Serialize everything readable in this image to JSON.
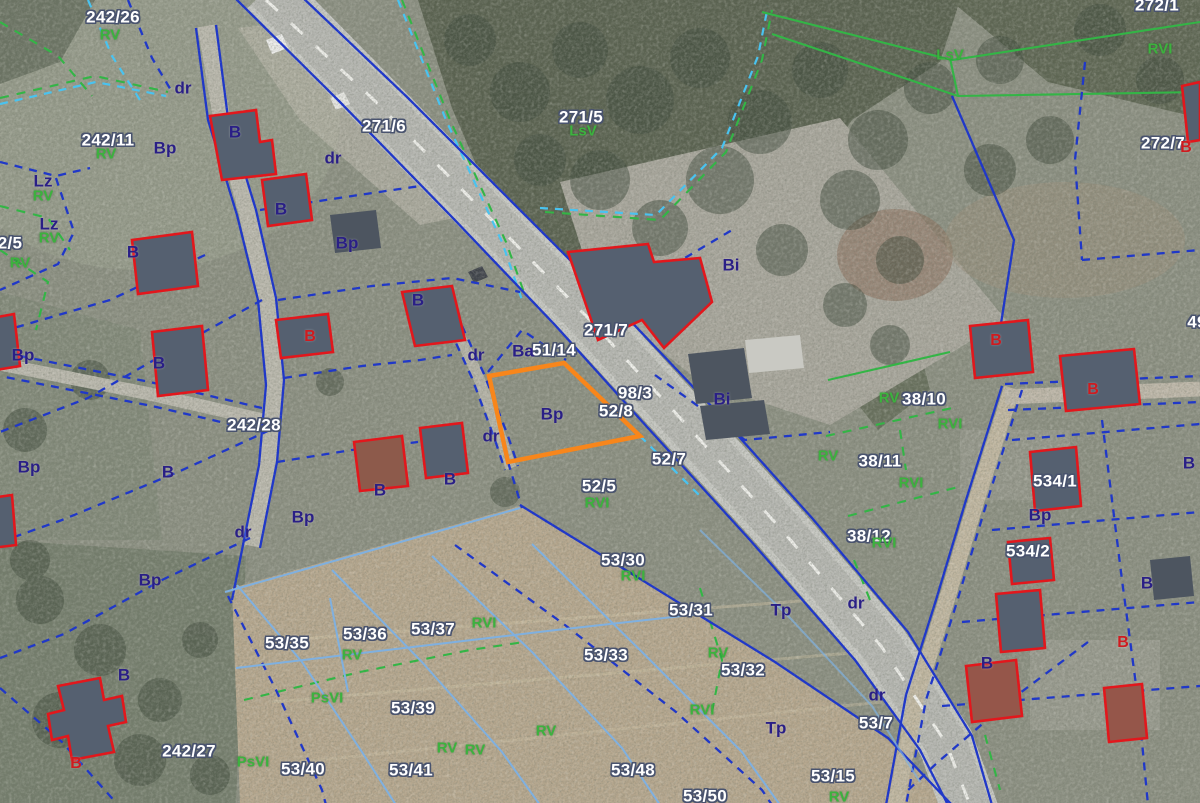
{
  "map": {
    "type": "cadastral-aerial-map",
    "colors": {
      "parcel_text": "#ffffff",
      "parcel_outline": "#49536e",
      "landuse_blue": "#2a1f86",
      "landuse_green": "#3cb23e",
      "building_red_label": "#cf1b1f",
      "boundary_navy": "#2038c8",
      "boundary_cyan": "#49c3f0",
      "boundary_green": "#33b546",
      "field_line_blue": "#7fb0e0",
      "building_outline": "#e2171c",
      "highlight_orange": "#f8861b",
      "road_dash_white": "#f0f0ec"
    },
    "highlighted_parcel": "52/8",
    "labels": [
      {
        "t": "242/26",
        "x": 113,
        "y": 17,
        "k": "p"
      },
      {
        "t": "271/6",
        "x": 384,
        "y": 126,
        "k": "p"
      },
      {
        "t": "271/5",
        "x": 581,
        "y": 117,
        "k": "p"
      },
      {
        "t": "242/11",
        "x": 108,
        "y": 140,
        "k": "p"
      },
      {
        "t": "272/1",
        "x": 1157,
        "y": 5,
        "k": "p"
      },
      {
        "t": "272/7",
        "x": 1163,
        "y": 143,
        "k": "p"
      },
      {
        "t": "2/5",
        "x": 10,
        "y": 243,
        "k": "p"
      },
      {
        "t": "271/7",
        "x": 606,
        "y": 330,
        "k": "p"
      },
      {
        "t": "51/14",
        "x": 554,
        "y": 350,
        "k": "p"
      },
      {
        "t": "98/3",
        "x": 635,
        "y": 393,
        "k": "p"
      },
      {
        "t": "52/8",
        "x": 616,
        "y": 411,
        "k": "p"
      },
      {
        "t": "242/28",
        "x": 254,
        "y": 425,
        "k": "p"
      },
      {
        "t": "38/10",
        "x": 924,
        "y": 399,
        "k": "p"
      },
      {
        "t": "52/7",
        "x": 669,
        "y": 459,
        "k": "p"
      },
      {
        "t": "38/11",
        "x": 880,
        "y": 461,
        "k": "p"
      },
      {
        "t": "52/5",
        "x": 599,
        "y": 486,
        "k": "p"
      },
      {
        "t": "534/1",
        "x": 1055,
        "y": 481,
        "k": "p"
      },
      {
        "t": "38/12",
        "x": 869,
        "y": 536,
        "k": "p"
      },
      {
        "t": "534/2",
        "x": 1028,
        "y": 551,
        "k": "p"
      },
      {
        "t": "53/30",
        "x": 623,
        "y": 560,
        "k": "p"
      },
      {
        "t": "49",
        "x": 1197,
        "y": 322,
        "k": "p"
      },
      {
        "t": "53/31",
        "x": 691,
        "y": 610,
        "k": "p"
      },
      {
        "t": "53/36",
        "x": 365,
        "y": 634,
        "k": "p"
      },
      {
        "t": "53/35",
        "x": 287,
        "y": 643,
        "k": "p"
      },
      {
        "t": "53/37",
        "x": 433,
        "y": 629,
        "k": "p"
      },
      {
        "t": "53/33",
        "x": 606,
        "y": 655,
        "k": "p"
      },
      {
        "t": "53/32",
        "x": 743,
        "y": 670,
        "k": "p"
      },
      {
        "t": "53/39",
        "x": 413,
        "y": 708,
        "k": "p"
      },
      {
        "t": "53/7",
        "x": 876,
        "y": 723,
        "k": "p"
      },
      {
        "t": "242/27",
        "x": 189,
        "y": 751,
        "k": "p"
      },
      {
        "t": "53/40",
        "x": 303,
        "y": 769,
        "k": "p"
      },
      {
        "t": "53/41",
        "x": 411,
        "y": 770,
        "k": "p"
      },
      {
        "t": "53/48",
        "x": 633,
        "y": 770,
        "k": "p"
      },
      {
        "t": "53/15",
        "x": 833,
        "y": 776,
        "k": "p"
      },
      {
        "t": "53/50",
        "x": 705,
        "y": 796,
        "k": "p"
      },
      {
        "t": "dr",
        "x": 183,
        "y": 88,
        "k": "u"
      },
      {
        "t": "B",
        "x": 235,
        "y": 132,
        "k": "u"
      },
      {
        "t": "Bp",
        "x": 165,
        "y": 148,
        "k": "u"
      },
      {
        "t": "dr",
        "x": 333,
        "y": 158,
        "k": "u"
      },
      {
        "t": "Lz",
        "x": 43,
        "y": 181,
        "k": "u"
      },
      {
        "t": "B",
        "x": 281,
        "y": 209,
        "k": "u"
      },
      {
        "t": "Lz",
        "x": 49,
        "y": 224,
        "k": "u"
      },
      {
        "t": "Bp",
        "x": 347,
        "y": 243,
        "k": "u"
      },
      {
        "t": "B",
        "x": 133,
        "y": 252,
        "k": "u"
      },
      {
        "t": "Bi",
        "x": 731,
        "y": 265,
        "k": "u"
      },
      {
        "t": "B",
        "x": 418,
        "y": 300,
        "k": "u"
      },
      {
        "t": "Ba",
        "x": 523,
        "y": 351,
        "k": "u"
      },
      {
        "t": "dr",
        "x": 476,
        "y": 355,
        "k": "u"
      },
      {
        "t": "Bp",
        "x": 23,
        "y": 355,
        "k": "u"
      },
      {
        "t": "B",
        "x": 159,
        "y": 363,
        "k": "u"
      },
      {
        "t": "Bi",
        "x": 722,
        "y": 399,
        "k": "u"
      },
      {
        "t": "Bp",
        "x": 552,
        "y": 414,
        "k": "u"
      },
      {
        "t": "dr",
        "x": 491,
        "y": 436,
        "k": "u"
      },
      {
        "t": "Bp",
        "x": 29,
        "y": 467,
        "k": "u"
      },
      {
        "t": "B",
        "x": 168,
        "y": 472,
        "k": "u"
      },
      {
        "t": "B",
        "x": 450,
        "y": 479,
        "k": "u"
      },
      {
        "t": "B",
        "x": 380,
        "y": 490,
        "k": "u"
      },
      {
        "t": "Bp",
        "x": 303,
        "y": 517,
        "k": "u"
      },
      {
        "t": "dr",
        "x": 243,
        "y": 532,
        "k": "u"
      },
      {
        "t": "Bp",
        "x": 150,
        "y": 580,
        "k": "u"
      },
      {
        "t": "Bp",
        "x": 1040,
        "y": 515,
        "k": "u"
      },
      {
        "t": "B",
        "x": 1189,
        "y": 463,
        "k": "u"
      },
      {
        "t": "dr",
        "x": 856,
        "y": 603,
        "k": "u"
      },
      {
        "t": "Tp",
        "x": 781,
        "y": 610,
        "k": "u"
      },
      {
        "t": "B",
        "x": 124,
        "y": 675,
        "k": "u"
      },
      {
        "t": "B",
        "x": 987,
        "y": 663,
        "k": "u"
      },
      {
        "t": "dr",
        "x": 877,
        "y": 695,
        "k": "u"
      },
      {
        "t": "Tp",
        "x": 776,
        "y": 728,
        "k": "u"
      },
      {
        "t": "B",
        "x": 1147,
        "y": 583,
        "k": "u"
      },
      {
        "t": "B",
        "x": 310,
        "y": 337,
        "k": "r"
      },
      {
        "t": "B",
        "x": 996,
        "y": 341,
        "k": "r"
      },
      {
        "t": "B",
        "x": 1093,
        "y": 390,
        "k": "r"
      },
      {
        "t": "B",
        "x": 1186,
        "y": 148,
        "k": "r"
      },
      {
        "t": "B",
        "x": 1123,
        "y": 643,
        "k": "r"
      },
      {
        "t": "B",
        "x": 76,
        "y": 764,
        "k": "r"
      },
      {
        "t": "RV",
        "x": 110,
        "y": 35,
        "k": "g"
      },
      {
        "t": "LsV",
        "x": 950,
        "y": 55,
        "k": "g"
      },
      {
        "t": "RVI",
        "x": 1160,
        "y": 49,
        "k": "g"
      },
      {
        "t": "RV",
        "x": 106,
        "y": 154,
        "k": "g"
      },
      {
        "t": "LsV",
        "x": 583,
        "y": 131,
        "k": "g"
      },
      {
        "t": "RV",
        "x": 43,
        "y": 196,
        "k": "g"
      },
      {
        "t": "RV",
        "x": 49,
        "y": 238,
        "k": "g"
      },
      {
        "t": "RV",
        "x": 20,
        "y": 263,
        "k": "g"
      },
      {
        "t": "RV",
        "x": 889,
        "y": 398,
        "k": "g"
      },
      {
        "t": "RVI",
        "x": 950,
        "y": 424,
        "k": "g"
      },
      {
        "t": "RV",
        "x": 828,
        "y": 456,
        "k": "g"
      },
      {
        "t": "RVI",
        "x": 911,
        "y": 483,
        "k": "g"
      },
      {
        "t": "RVI",
        "x": 884,
        "y": 543,
        "k": "g"
      },
      {
        "t": "RVI",
        "x": 597,
        "y": 503,
        "k": "g"
      },
      {
        "t": "RVI",
        "x": 633,
        "y": 576,
        "k": "g"
      },
      {
        "t": "RV",
        "x": 352,
        "y": 655,
        "k": "g"
      },
      {
        "t": "RVI",
        "x": 484,
        "y": 623,
        "k": "g"
      },
      {
        "t": "RV",
        "x": 718,
        "y": 653,
        "k": "g"
      },
      {
        "t": "PsVI",
        "x": 327,
        "y": 698,
        "k": "g"
      },
      {
        "t": "RVI",
        "x": 702,
        "y": 710,
        "k": "g"
      },
      {
        "t": "RV",
        "x": 546,
        "y": 731,
        "k": "g"
      },
      {
        "t": "RV",
        "x": 447,
        "y": 748,
        "k": "g"
      },
      {
        "t": "RV",
        "x": 475,
        "y": 750,
        "k": "g"
      },
      {
        "t": "PsVI",
        "x": 253,
        "y": 762,
        "k": "g"
      },
      {
        "t": "RV",
        "x": 839,
        "y": 797,
        "k": "g"
      }
    ]
  }
}
